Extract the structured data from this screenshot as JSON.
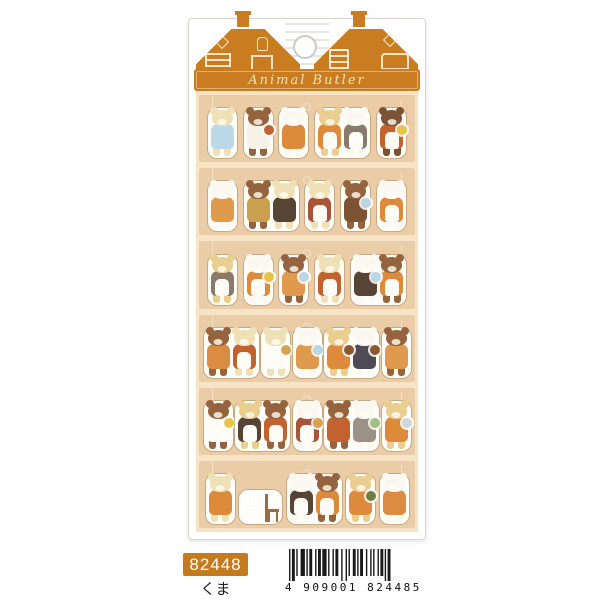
{
  "title_banner": {
    "text": "Animal Butler"
  },
  "product_label": {
    "item_code": "82448",
    "item_name": "くま"
  },
  "barcode": {
    "digits": "4 909001 824485"
  },
  "colors": {
    "roof_orange": "#c97d20",
    "badge_orange": "#c57a1c",
    "sheet_bg": "#f7e4c6",
    "row_band": "#eacda6",
    "card_bg": "#ffffff"
  },
  "sheet": {
    "rows": [
      {
        "stickers": [
          {
            "bears": [
              {
                "body": "#f0e0b5",
                "outfit": "#bcd8e8"
              }
            ]
          },
          {
            "bears": [
              {
                "body": "#95643e",
                "outfit": "#f6f2e7",
                "prop": "#c2622f"
              }
            ]
          },
          {
            "bears": [
              {
                "body": "#faf8f1",
                "outfit": "#dd8a3a"
              }
            ]
          },
          {
            "bears": [
              {
                "body": "#e9ce8f",
                "outfit": "#dd8a3a",
                "apron": true
              },
              {
                "body": "#faf8f1",
                "outfit": "#8a7a6b",
                "apron": true
              }
            ]
          },
          {
            "bears": [
              {
                "body": "#7b5233",
                "outfit": "#c2622f",
                "apron": true,
                "prop": "#e8c34a"
              }
            ]
          }
        ]
      },
      {
        "stickers": [
          {
            "bears": [
              {
                "body": "#faf8f1",
                "outfit": "#e09a4e"
              }
            ]
          },
          {
            "bears": [
              {
                "body": "#95643e",
                "outfit": "#caa04f"
              },
              {
                "body": "#f0e0b5",
                "outfit": "#564434"
              }
            ]
          },
          {
            "bears": [
              {
                "body": "#f0e0b5",
                "outfit": "#a9533a",
                "apron": true
              }
            ]
          },
          {
            "bears": [
              {
                "body": "#95643e",
                "outfit": "#7c5433",
                "prop": "#b9d6e6"
              }
            ]
          },
          {
            "bears": [
              {
                "body": "#faf8f1",
                "outfit": "#dd8a3a",
                "apron": true
              }
            ]
          }
        ]
      },
      {
        "stickers": [
          {
            "bears": [
              {
                "body": "#e9ce8f",
                "outfit": "#8a7a6b",
                "apron": true
              }
            ]
          },
          {
            "bears": [
              {
                "body": "#faf8f1",
                "outfit": "#dd8a3a",
                "apron": true,
                "prop": "#e8c34a"
              }
            ]
          },
          {
            "bears": [
              {
                "body": "#95643e",
                "outfit": "#e09a4e",
                "prop": "#b9d6e6"
              }
            ]
          },
          {
            "bears": [
              {
                "body": "#f0e0b5",
                "outfit": "#c2622f",
                "apron": true
              }
            ]
          },
          {
            "bears": [
              {
                "body": "#faf8f1",
                "outfit": "#564434",
                "prop": "#b9d6e6"
              },
              {
                "body": "#95643e",
                "outfit": "#dd8a3a",
                "apron": true
              }
            ]
          }
        ]
      },
      {
        "stickers": [
          {
            "bears": [
              {
                "body": "#95643e",
                "outfit": "#d98c42"
              },
              {
                "body": "#f0e0b5",
                "outfit": "#c2622f",
                "apron": true
              }
            ]
          },
          {
            "bears": [
              {
                "body": "#f0e0b5",
                "outfit": "#fdfbf6",
                "prop": "#d8a24e"
              }
            ]
          },
          {
            "bears": [
              {
                "body": "#faf8f1",
                "outfit": "#e09a4e",
                "prop": "#b9d6e6"
              }
            ]
          },
          {
            "bears": [
              {
                "body": "#e9ce8f",
                "outfit": "#dd8a3a",
                "prop": "#8a5a2e"
              },
              {
                "body": "#faf8f1",
                "outfit": "#4f4a55",
                "prop": "#8a5a2e"
              }
            ]
          },
          {
            "bears": [
              {
                "body": "#95643e",
                "outfit": "#e09a4e"
              }
            ]
          }
        ]
      },
      {
        "stickers": [
          {
            "bears": [
              {
                "body": "#95643e",
                "outfit": "#fdfbf6",
                "prop": "#e8c34a"
              }
            ]
          },
          {
            "bears": [
              {
                "body": "#e9ce8f",
                "outfit": "#564434",
                "apron": true
              },
              {
                "body": "#95643e",
                "outfit": "#c2622f",
                "apron": true
              }
            ]
          },
          {
            "bears": [
              {
                "body": "#faf8f1",
                "outfit": "#a9533a",
                "apron": true,
                "prop": "#d8a24e"
              }
            ]
          },
          {
            "bears": [
              {
                "body": "#95643e",
                "outfit": "#c2622f"
              },
              {
                "body": "#faf8f1",
                "outfit": "#9b9187",
                "prop": "#9fbf86"
              }
            ]
          },
          {
            "bears": [
              {
                "body": "#e9ce8f",
                "outfit": "#dd8a3a",
                "prop": "#cfd6dc"
              }
            ]
          }
        ]
      },
      {
        "stickers": [
          {
            "bears": [
              {
                "body": "#f0e0b5",
                "outfit": "#dd8a3a"
              }
            ]
          },
          {
            "objects": [
              "window",
              "chair"
            ]
          },
          {
            "bears": [
              {
                "body": "#faf8f1",
                "outfit": "#564434",
                "apron": true
              },
              {
                "body": "#95643e",
                "outfit": "#dd8a3a",
                "apron": true
              }
            ]
          },
          {
            "bears": [
              {
                "body": "#e9ce8f",
                "outfit": "#dd8a3a",
                "prop": "#6f7f3f"
              }
            ]
          },
          {
            "bears": [
              {
                "body": "#faf8f1",
                "outfit": "#d98c42"
              }
            ]
          }
        ]
      }
    ]
  }
}
